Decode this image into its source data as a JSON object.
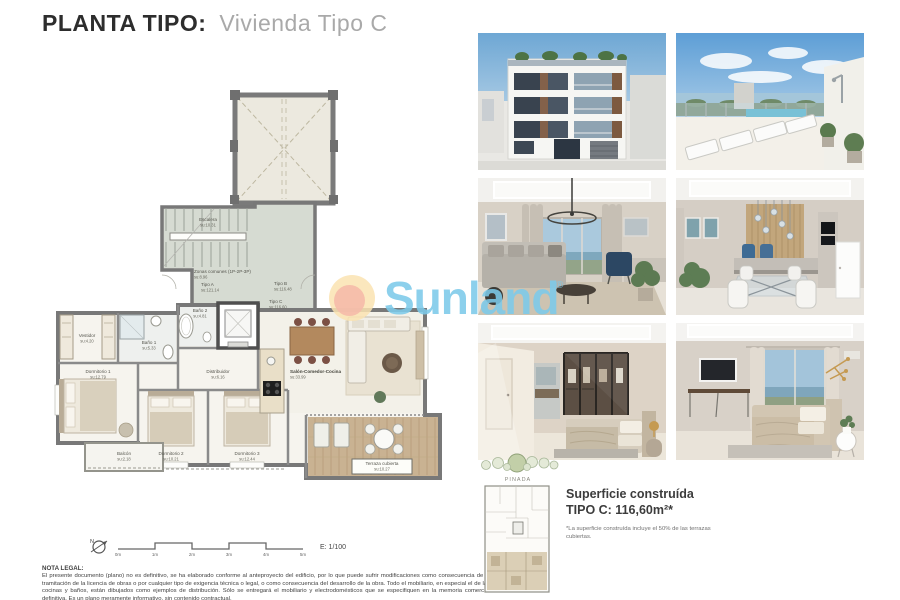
{
  "header": {
    "title_main": "PLANTA TIPO:",
    "title_sub": "Vivienda Tipo C"
  },
  "watermark": {
    "brand": "Sunland",
    "reg": "®"
  },
  "plan": {
    "labels": {
      "escalera": {
        "name": "Escalera",
        "area": "su:10.31"
      },
      "zonas": {
        "name": "Zonas comunes (1P-2P-3P)",
        "area": "su:8.96"
      },
      "tipo_a": {
        "name": "Tipo A",
        "area": "su:121.14"
      },
      "tipo_b": {
        "name": "Tipo B",
        "area": "su:116.48"
      },
      "tipo_c": {
        "name": "Tipo C",
        "area": "su:116.60"
      },
      "vestidor": {
        "name": "Vestidor",
        "area": "su:4.20"
      },
      "bano1": {
        "name": "Baño 1",
        "area": "su:5.33"
      },
      "bano2": {
        "name": "Baño 2",
        "area": "su:4.81"
      },
      "dorm1": {
        "name": "Dormitorio 1",
        "area": "su:12.79"
      },
      "distribuidor": {
        "name": "Distribuidor",
        "area": "su:6.16"
      },
      "balcon": {
        "name": "Balcón",
        "area": "su:2.18"
      },
      "dorm2": {
        "name": "Dormitorio 2",
        "area": "su:10.21"
      },
      "dorm3": {
        "name": "Dormitorio 3",
        "area": "su:12.44"
      },
      "salon": {
        "name": "Salón-Comedor-Cocina",
        "area": "su:33.99"
      },
      "terraza": {
        "name": "Terraza cubierta",
        "area": "su:10.27"
      }
    },
    "scale": {
      "north": "N",
      "ticks": [
        "0m",
        "1m",
        "2m",
        "3m",
        "4m",
        "5m"
      ],
      "label": "E: 1/100"
    }
  },
  "keyplan": {
    "label": "PINADA"
  },
  "surface": {
    "line1": "Superficie construída",
    "line2": "TIPO C: 116,60m²*",
    "footnote": "*La superficie construída incluye el 50% de las terrazas cubiertas."
  },
  "legal": {
    "title": "NOTA LEGAL:",
    "body": "El presente documento (plano) no es definitivo, se ha elaborado conforme al anteproyecto del edificio, por lo que puede sufrir modificaciones como consecuencia de la tramitación de la licencia de obras o por cualquier tipo de exigencia técnica o legal, o como consecuencia del desarrollo de la obra. Todo el mobiliario, en especial el de las cocinas y baños, están dibujados como ejemplos de distribución. Sólo se entregará el mobiliario y electrodomésticos que se especifiquen en la memoria comercial definitiva. Es un plano meramente informativo, sin contenido contractual."
  },
  "colors": {
    "accent_blue": "#7cc9e9",
    "sun_outer": "#fae3b2",
    "sun_inner": "#f5baa8",
    "wood": "#c9b292"
  }
}
